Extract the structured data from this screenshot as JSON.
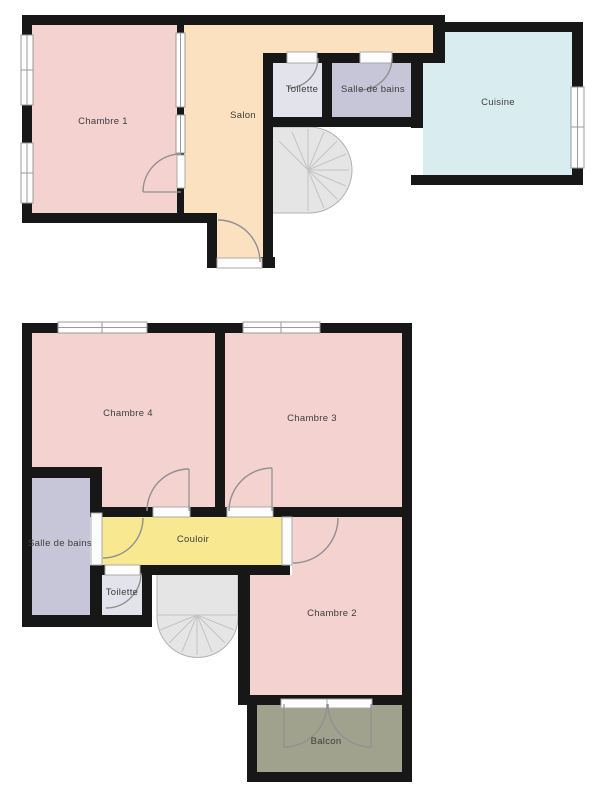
{
  "document": {
    "type": "floor-plan",
    "background": "#ffffff"
  },
  "colors": {
    "wall": "#171717",
    "room_pink": "#f4d2cf",
    "salon_tan": "#fbe1c0",
    "cuisine_blue": "#d9edf0",
    "toilette_gray": "#e3e3ec",
    "bathroom_lavender": "#c6c6d8",
    "couloir_yellow": "#f8e88f",
    "balcon_olive": "#a1a28e",
    "stairs_fill": "#e5e5e5",
    "stairs_line": "#c4c4c4",
    "stairs_border": "#b2b2b2",
    "window_fill": "#fdfdfd",
    "window_frame": "#9b9b9b",
    "door_arc": "#909090",
    "label_text": "#3d3d3d"
  },
  "floors": {
    "upper": {
      "labels": {
        "chambre1": "Chambre 1",
        "salon": "Salon",
        "toilette": "Toilette",
        "salle_de_bains": "Salle de bains",
        "cuisine": "Cuisine"
      }
    },
    "lower": {
      "labels": {
        "chambre4": "Chambre 4",
        "chambre3": "Chambre 3",
        "salle_de_bains": "Salle de bains",
        "couloir": "Couloir",
        "toilette": "Toilette",
        "chambre2": "Chambre 2",
        "balcon": "Balcon"
      }
    }
  }
}
